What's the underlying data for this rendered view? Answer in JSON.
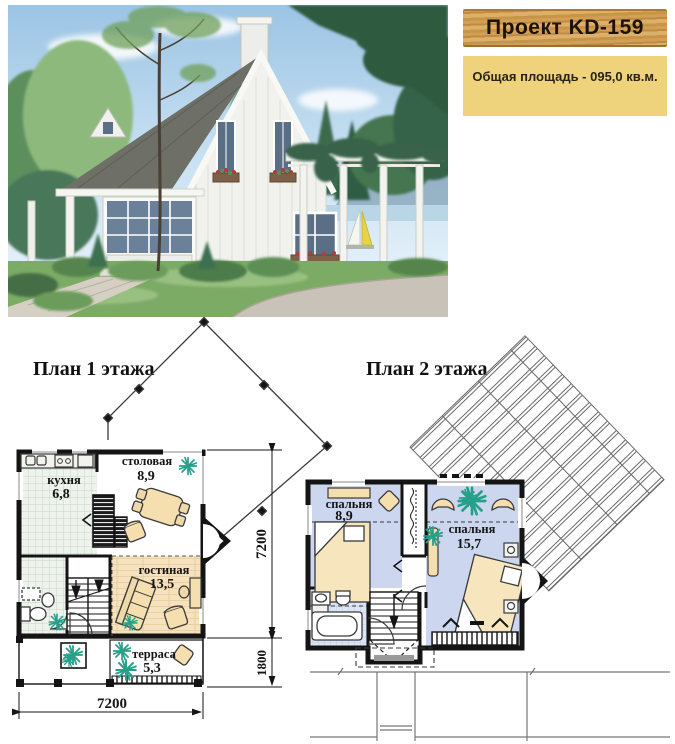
{
  "header": {
    "project_title": "Проект KD-159",
    "total_area": "Общая площадь -  095,0 кв.м."
  },
  "floor1": {
    "title": "План 1 этажа",
    "rooms": {
      "kitchen": {
        "name": "кухня",
        "area": "6,8"
      },
      "dining": {
        "name": "столовая",
        "area": "8,9"
      },
      "living": {
        "name": "гостиная",
        "area": "13,5"
      },
      "terrace": {
        "name": "терраса",
        "area": "5,3"
      }
    },
    "dims": {
      "bottom_width": "7200",
      "right_height": "7200",
      "terrace_depth": "1800"
    }
  },
  "floor2": {
    "title": "План 2 этажа",
    "rooms": {
      "bedroom_small": {
        "name": "спальня",
        "area": "8,9"
      },
      "bedroom_large": {
        "name": "спальня",
        "area": "15,7"
      }
    }
  },
  "colors": {
    "wood_plate": "#c99a52",
    "area_panel": "#eed27c",
    "living_wood_floor": "#f6e2bd",
    "bedroom_floor": "#ccd7ef",
    "tile_floor": "#eef3ec",
    "furniture_tan": "#f6dfae",
    "plant_green": "#27a08a",
    "wall_black": "#141414"
  }
}
